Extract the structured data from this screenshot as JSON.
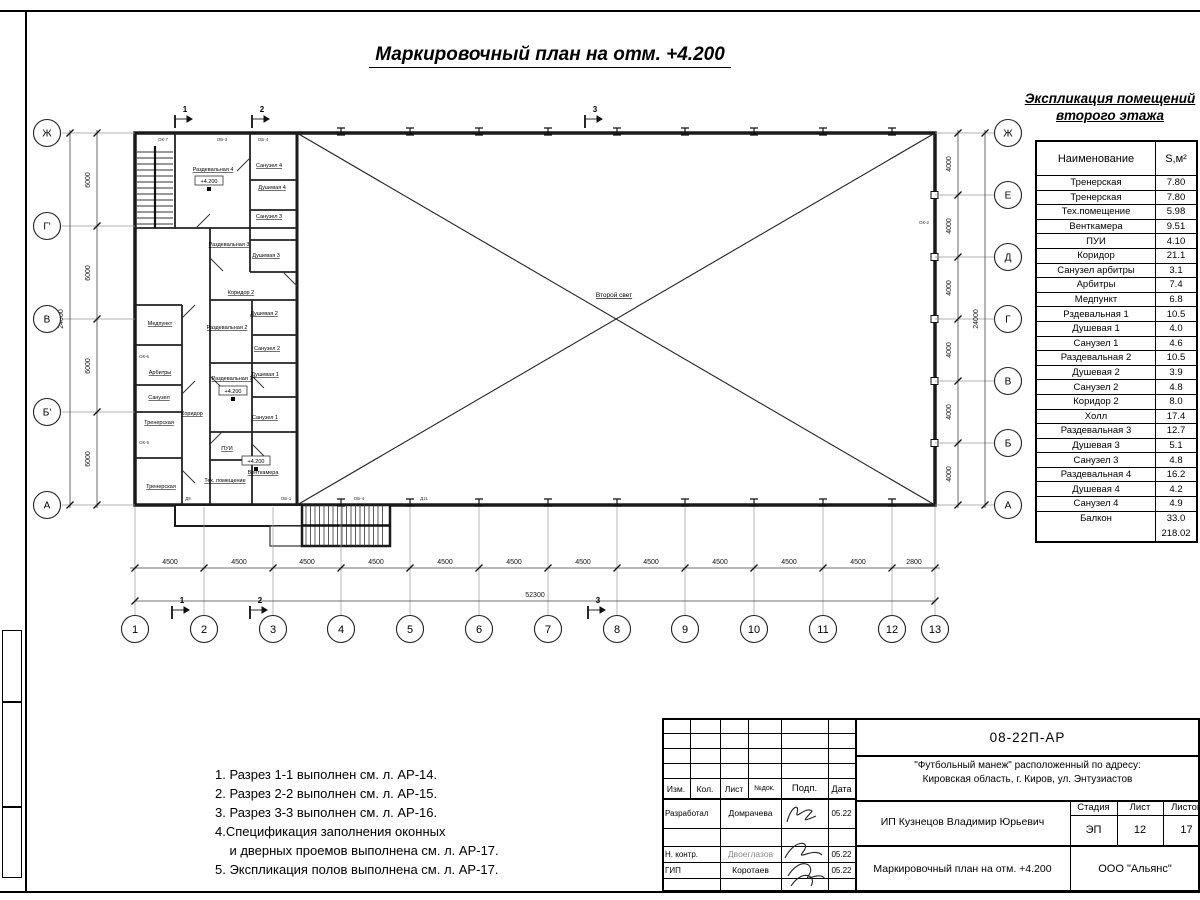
{
  "sheet": {
    "title": "Маркировочный план на отм. +4.200"
  },
  "schedule": {
    "title_line1": "Экспликация помещений",
    "title_line2": "второго этажа",
    "col_name": "Наименование",
    "col_area": "S,м²",
    "rows": [
      {
        "name": "Тренерская",
        "area": "7.80"
      },
      {
        "name": "Тренерская",
        "area": "7.80"
      },
      {
        "name": "Тех.помещение",
        "area": "5.98"
      },
      {
        "name": "Венткамера",
        "area": "9.51"
      },
      {
        "name": "ПУИ",
        "area": "4.10"
      },
      {
        "name": "Коридор",
        "area": "21.1"
      },
      {
        "name": "Санузел арбитры",
        "area": "3.1"
      },
      {
        "name": "Арбитры",
        "area": "7.4"
      },
      {
        "name": "Медпункт",
        "area": "6.8"
      },
      {
        "name": "Рздевальная 1",
        "area": "10.5"
      },
      {
        "name": "Душевая 1",
        "area": "4.0"
      },
      {
        "name": "Санузел 1",
        "area": "4.6"
      },
      {
        "name": "Раздевальная 2",
        "area": "10.5"
      },
      {
        "name": "Душевая 2",
        "area": "3.9"
      },
      {
        "name": "Санузел 2",
        "area": "4.8"
      },
      {
        "name": "Коридор 2",
        "area": "8.0"
      },
      {
        "name": "Холл",
        "area": "17.4"
      },
      {
        "name": "Раздевальная 3",
        "area": "12.7"
      },
      {
        "name": "Душевая 3",
        "area": "5.1"
      },
      {
        "name": "Санузел 3",
        "area": "4.8"
      },
      {
        "name": "Раздевальная 4",
        "area": "16.2"
      },
      {
        "name": "Душевая 4",
        "area": "4.2"
      },
      {
        "name": "Санузел 4",
        "area": "4.9"
      },
      {
        "name": "Балкон",
        "area": "33.0"
      }
    ],
    "total": "218.02"
  },
  "notes": {
    "lines": [
      "1. Разрез 1-1 выполнен см. л. АР-14.",
      "2. Разрез 2-2 выполнен см. л. АР-15.",
      "3. Разрез 3-3 выполнен см. л. АР-16.",
      "4.Спецификация заполнения оконных",
      "    и дверных проемов выполнена см. л. АР-17.",
      "5. Экспликация полов выполнена см. л. АР-17."
    ]
  },
  "plan": {
    "hall_label": "Второй свет",
    "elevation_mark": "+4.200",
    "axes_bottom": [
      "1",
      "2",
      "3",
      "4",
      "5",
      "6",
      "7",
      "8",
      "9",
      "10",
      "11",
      "12",
      "13"
    ],
    "axes_left": [
      "Ж",
      "Г'",
      "В",
      "Б'",
      "А"
    ],
    "axes_right": [
      "Ж",
      "Е",
      "Д",
      "Г",
      "В",
      "Б",
      "А"
    ],
    "dims_bottom": [
      "4500",
      "4500",
      "4500",
      "4500",
      "4500",
      "4500",
      "4500",
      "4500",
      "4500",
      "4500",
      "4500",
      "2800"
    ],
    "dim_bottom_total": "52300",
    "dims_left": [
      "6000",
      "6000",
      "6000",
      "6000"
    ],
    "dim_left_total": "24000",
    "dims_right": [
      "4000",
      "4000",
      "4000",
      "4000",
      "4000",
      "4000"
    ],
    "dim_right_total": "24000",
    "sections": [
      "1",
      "2",
      "3"
    ],
    "rooms": [
      "Раздевальная 4",
      "Санузел 4",
      "Душевая 4",
      "Санузел 3",
      "Душевая 3",
      "Раздевальная 3",
      "Коридор 2",
      "Медпункт",
      "Душевая 2",
      "Раздевальная 2",
      "Санузел 2",
      "Арбитры",
      "Санузел",
      "Душевая 1",
      "Раздевальная 1",
      "Санузел 1",
      "Коридор",
      "Тренерская",
      "Тренерская",
      "ПУИ",
      "Тех. помещение",
      "Венткамера"
    ],
    "tags": [
      "ОК-7",
      "ОБ-3",
      "ОБ-4",
      "ОК-6",
      "ОК-5",
      "ОК-2",
      "Д9",
      "ОБ-1",
      "ОБ-4",
      "Д11"
    ]
  },
  "titleblock": {
    "doc_number": "08-22П-АР",
    "project_line1": "\"Футбольный манеж\" расположенный по адресу:",
    "project_line2": "Кировская область, г. Киров, ул. Энтузиастов",
    "client": "ИП Кузнецов Владимир Юрьевич",
    "drawing_title": "Маркировочный план на отм. +4.200",
    "company": "ООО \"Альянс\"",
    "stage_label": "Стадия",
    "sheet_label": "Лист",
    "sheets_label": "Листов",
    "stage": "ЭП",
    "sheet_no": "12",
    "sheets_total": "17",
    "cols": [
      "Изм.",
      "Кол.",
      "Лист",
      "№док.",
      "Подп.",
      "Дата"
    ],
    "rows": [
      {
        "role": "Разработал",
        "name": "Домрачева",
        "date": "05.22"
      },
      {
        "role": "Н. контр.",
        "name": "Двоеглазов",
        "date": "05.22"
      },
      {
        "role": "ГИП",
        "name": "Коротаев",
        "date": "05.22"
      }
    ]
  }
}
